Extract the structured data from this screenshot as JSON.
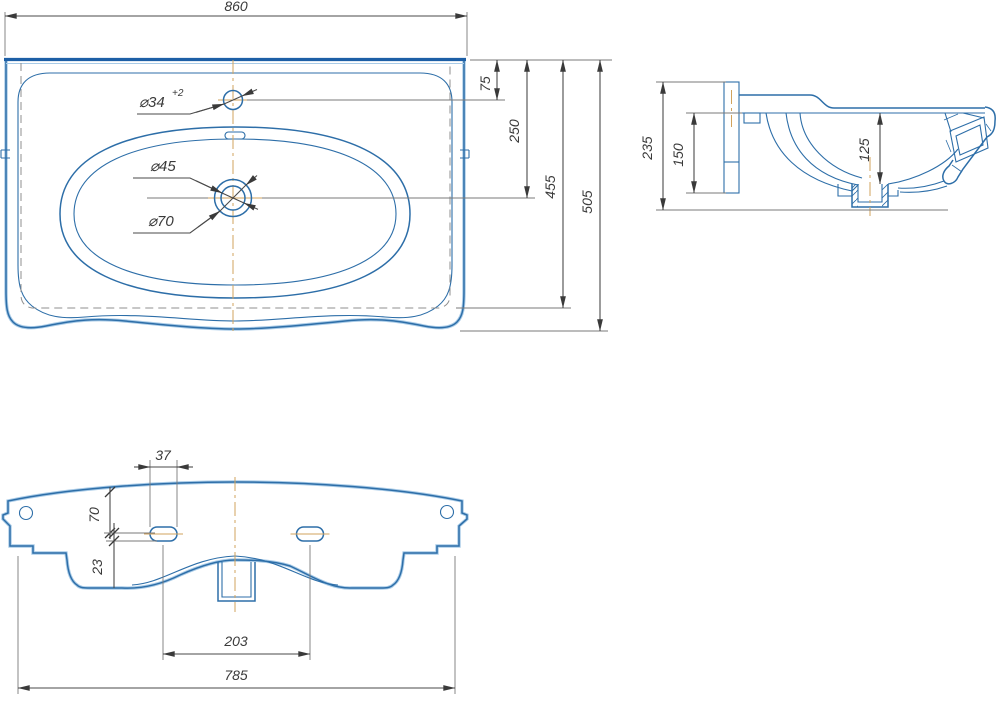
{
  "drawing": {
    "title": "Washbasin dimensional drawing, three views",
    "colors": {
      "outline_blue": "#2d6ea8",
      "outline_light_blue": "#a9cbe7",
      "dimension_gray": "#4a4a4a",
      "centerline_orange": "#d2a35c"
    },
    "top_view": {
      "overall_width": "860",
      "back_to_faucet_hole": "75",
      "back_to_drain_center": "250",
      "depth_to_hidden_edge": "455",
      "overall_depth": "505",
      "faucet_hole_diameter": "⌀34",
      "faucet_hole_tolerance": "+2",
      "drain_inner_diameter": "⌀45",
      "drain_outer_diameter": "⌀70"
    },
    "side_view": {
      "overall_height": "235",
      "flange_height": "150",
      "bowl_depth": "125"
    },
    "bottom_view": {
      "slot_width": "37",
      "top_edge_to_slot": "70",
      "slot_vertical_offset": "23",
      "slot_spacing": "203",
      "mounting_width": "785"
    }
  }
}
